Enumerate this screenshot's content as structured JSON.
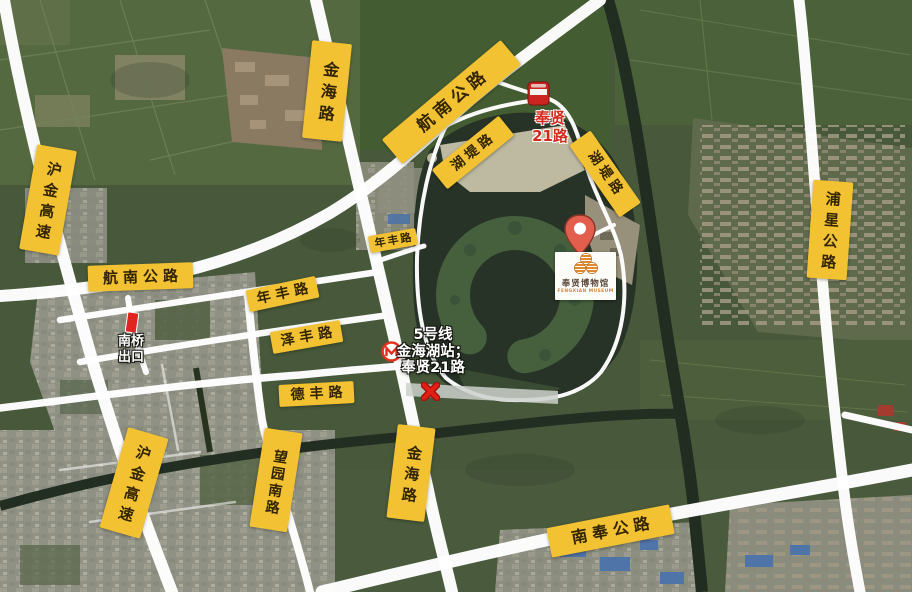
{
  "map": {
    "kind": "satellite-road-map",
    "badge_color": "#F2C233",
    "road_color": "#FFFFFF",
    "alert_red": "#D42B20"
  },
  "road_labels": [
    {
      "id": "jinhai-north",
      "text": "金海路"
    },
    {
      "id": "hangnan-diagonal",
      "text": "航南公路"
    },
    {
      "id": "hudi-west",
      "text": "湖堤路"
    },
    {
      "id": "hudi-east",
      "text": "湖堤路"
    },
    {
      "id": "hujin-north",
      "text": "沪金高速"
    },
    {
      "id": "hangnan-west",
      "text": "航南公路"
    },
    {
      "id": "nianfeng-east",
      "text": "年丰路"
    },
    {
      "id": "nianfeng",
      "text": "年丰路"
    },
    {
      "id": "zefeng",
      "text": "泽丰路"
    },
    {
      "id": "defeng",
      "text": "德丰路"
    },
    {
      "id": "wangyuan-south",
      "text": "望园南路"
    },
    {
      "id": "hujin-south",
      "text": "沪金高速"
    },
    {
      "id": "jinhai-south",
      "text": "金海路"
    },
    {
      "id": "nanfeng",
      "text": "南奉公路"
    },
    {
      "id": "puxing",
      "text": "浦星公路"
    }
  ],
  "markers": {
    "bus_stop": {
      "icon": "bus-stop-icon",
      "line1": "奉贤",
      "line2": "21路"
    },
    "nanqiao_exit": {
      "icon": "exit-bar-icon",
      "line1": "南桥",
      "line2": "出口"
    },
    "metro": {
      "icon": "metro-logo-icon",
      "line1": "5号线",
      "line2": "金海湖站；",
      "line3": "奉贤21路"
    },
    "closure": {
      "icon": "closed-x-icon"
    },
    "museum": {
      "icon": "location-pin-icon",
      "logo": "museum-logo-icon",
      "name": "奉贤博物馆",
      "name_en": "FENGXIAN MUSEUM"
    }
  }
}
